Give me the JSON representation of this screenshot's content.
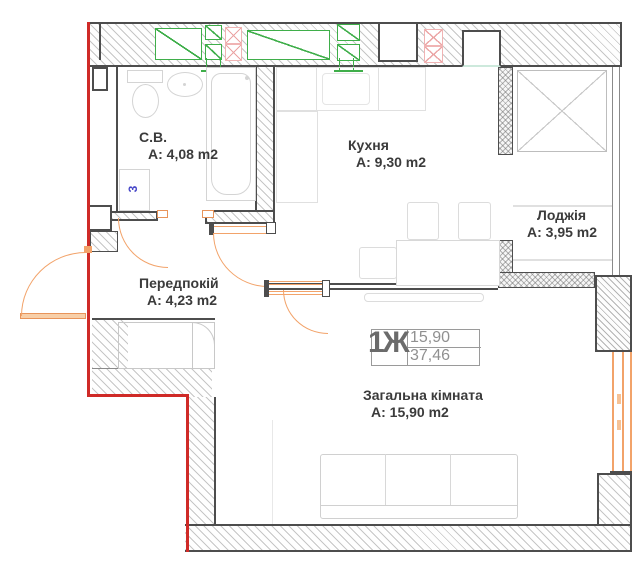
{
  "plan": {
    "title": "1-room apartment floor plan",
    "rooms": {
      "bathroom": {
        "name": "С.В.",
        "area": "A: 4,08 m2"
      },
      "kitchen": {
        "name": "Кухня",
        "area": "A: 9,30 m2"
      },
      "loggia": {
        "name": "Лоджія",
        "area": "A: 3,95 m2"
      },
      "hallway": {
        "name": "Передпокій",
        "area": "A: 4,23 m2"
      },
      "living_room": {
        "name": "Загальна кімната",
        "area": "A: 15,90 m2"
      }
    },
    "stamp": {
      "unit_label": "1Ж",
      "living_area": "15,90",
      "total_area": "37,46"
    },
    "symbols": {
      "washer_mark": "3"
    },
    "colors": {
      "boundary_red": "#cf2a27",
      "door_window_orange": "#f2a36a",
      "vent_green": "#3fae4a",
      "vent_pink": "#eba4a4",
      "wall_dark": "#4d4d4d",
      "furniture_gray": "#d4d4d4",
      "label_text": "#3b3b3b",
      "stamp_gray": "#909090",
      "washer_blue": "#4646c8"
    }
  }
}
